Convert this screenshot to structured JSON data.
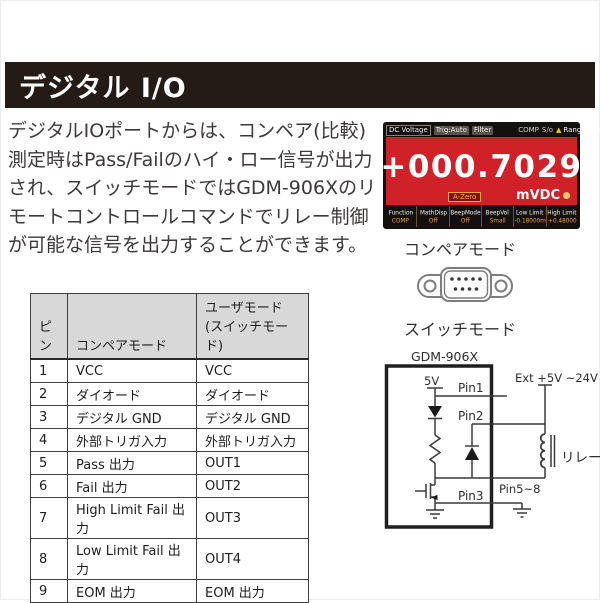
{
  "header": {
    "title": "デジタル I/O"
  },
  "intro": {
    "text": "デジタルIOポートからは、コンペア(比較) 測定時はPass/Failのハイ・ロー信号が出力され、スイッチモードではGDM-906Xのリモートコントロールコマンドでリレー制御が可能な信号を出力することができます。"
  },
  "display": {
    "top_bar": [
      "DC Voltage",
      "Trig:Auto",
      "Filter",
      "COMP",
      "S/o",
      "Range: 100mV"
    ],
    "reading": "+000.7029",
    "azero_badge": "A-Zero",
    "unit": "mVDC",
    "bottom": {
      "labels": [
        "Function",
        "MathDisp",
        "BeepMode",
        "BeepVol",
        "Low Limit",
        "High Limit"
      ],
      "values": [
        "COMP",
        "Off",
        "Off",
        "Small",
        "-0.18000m",
        "+0.48000"
      ]
    }
  },
  "labels": {
    "compare_mode": "コンペアモード",
    "switch_mode": "スイッチモード"
  },
  "table": {
    "header_pin": "ピン",
    "header_compare": "コンペアモード",
    "header_user_line1": "ユーザモード",
    "header_user_line2": "(スイッチモード)",
    "rows": [
      [
        "1",
        "VCC",
        "VCC"
      ],
      [
        "2",
        "ダイオード",
        "ダイオード"
      ],
      [
        "3",
        "デジタル GND",
        "デジタル GND"
      ],
      [
        "4",
        "外部トリガ入力",
        "外部トリガ入力"
      ],
      [
        "5",
        "Pass 出力",
        "OUT1"
      ],
      [
        "6",
        "Fail 出力",
        "OUT2"
      ],
      [
        "7",
        "High Limit Fail 出力",
        "OUT3"
      ],
      [
        "8",
        "Low Limit Fail 出力",
        "OUT4"
      ],
      [
        "9",
        "EOM 出力",
        "EOM 出力"
      ]
    ]
  },
  "circuit": {
    "device": "GDM-906X",
    "supply": "5V",
    "pin1": "Pin1",
    "pin2": "Pin2",
    "pin3": "Pin3",
    "pin5_8": "Pin5~8",
    "ext_supply": "Ext +5V ~24V",
    "relay": "リレー"
  },
  "colors": {
    "header_bar": "#251b16",
    "display_red": "#cf2127",
    "value_orange": "#f0a13a"
  }
}
